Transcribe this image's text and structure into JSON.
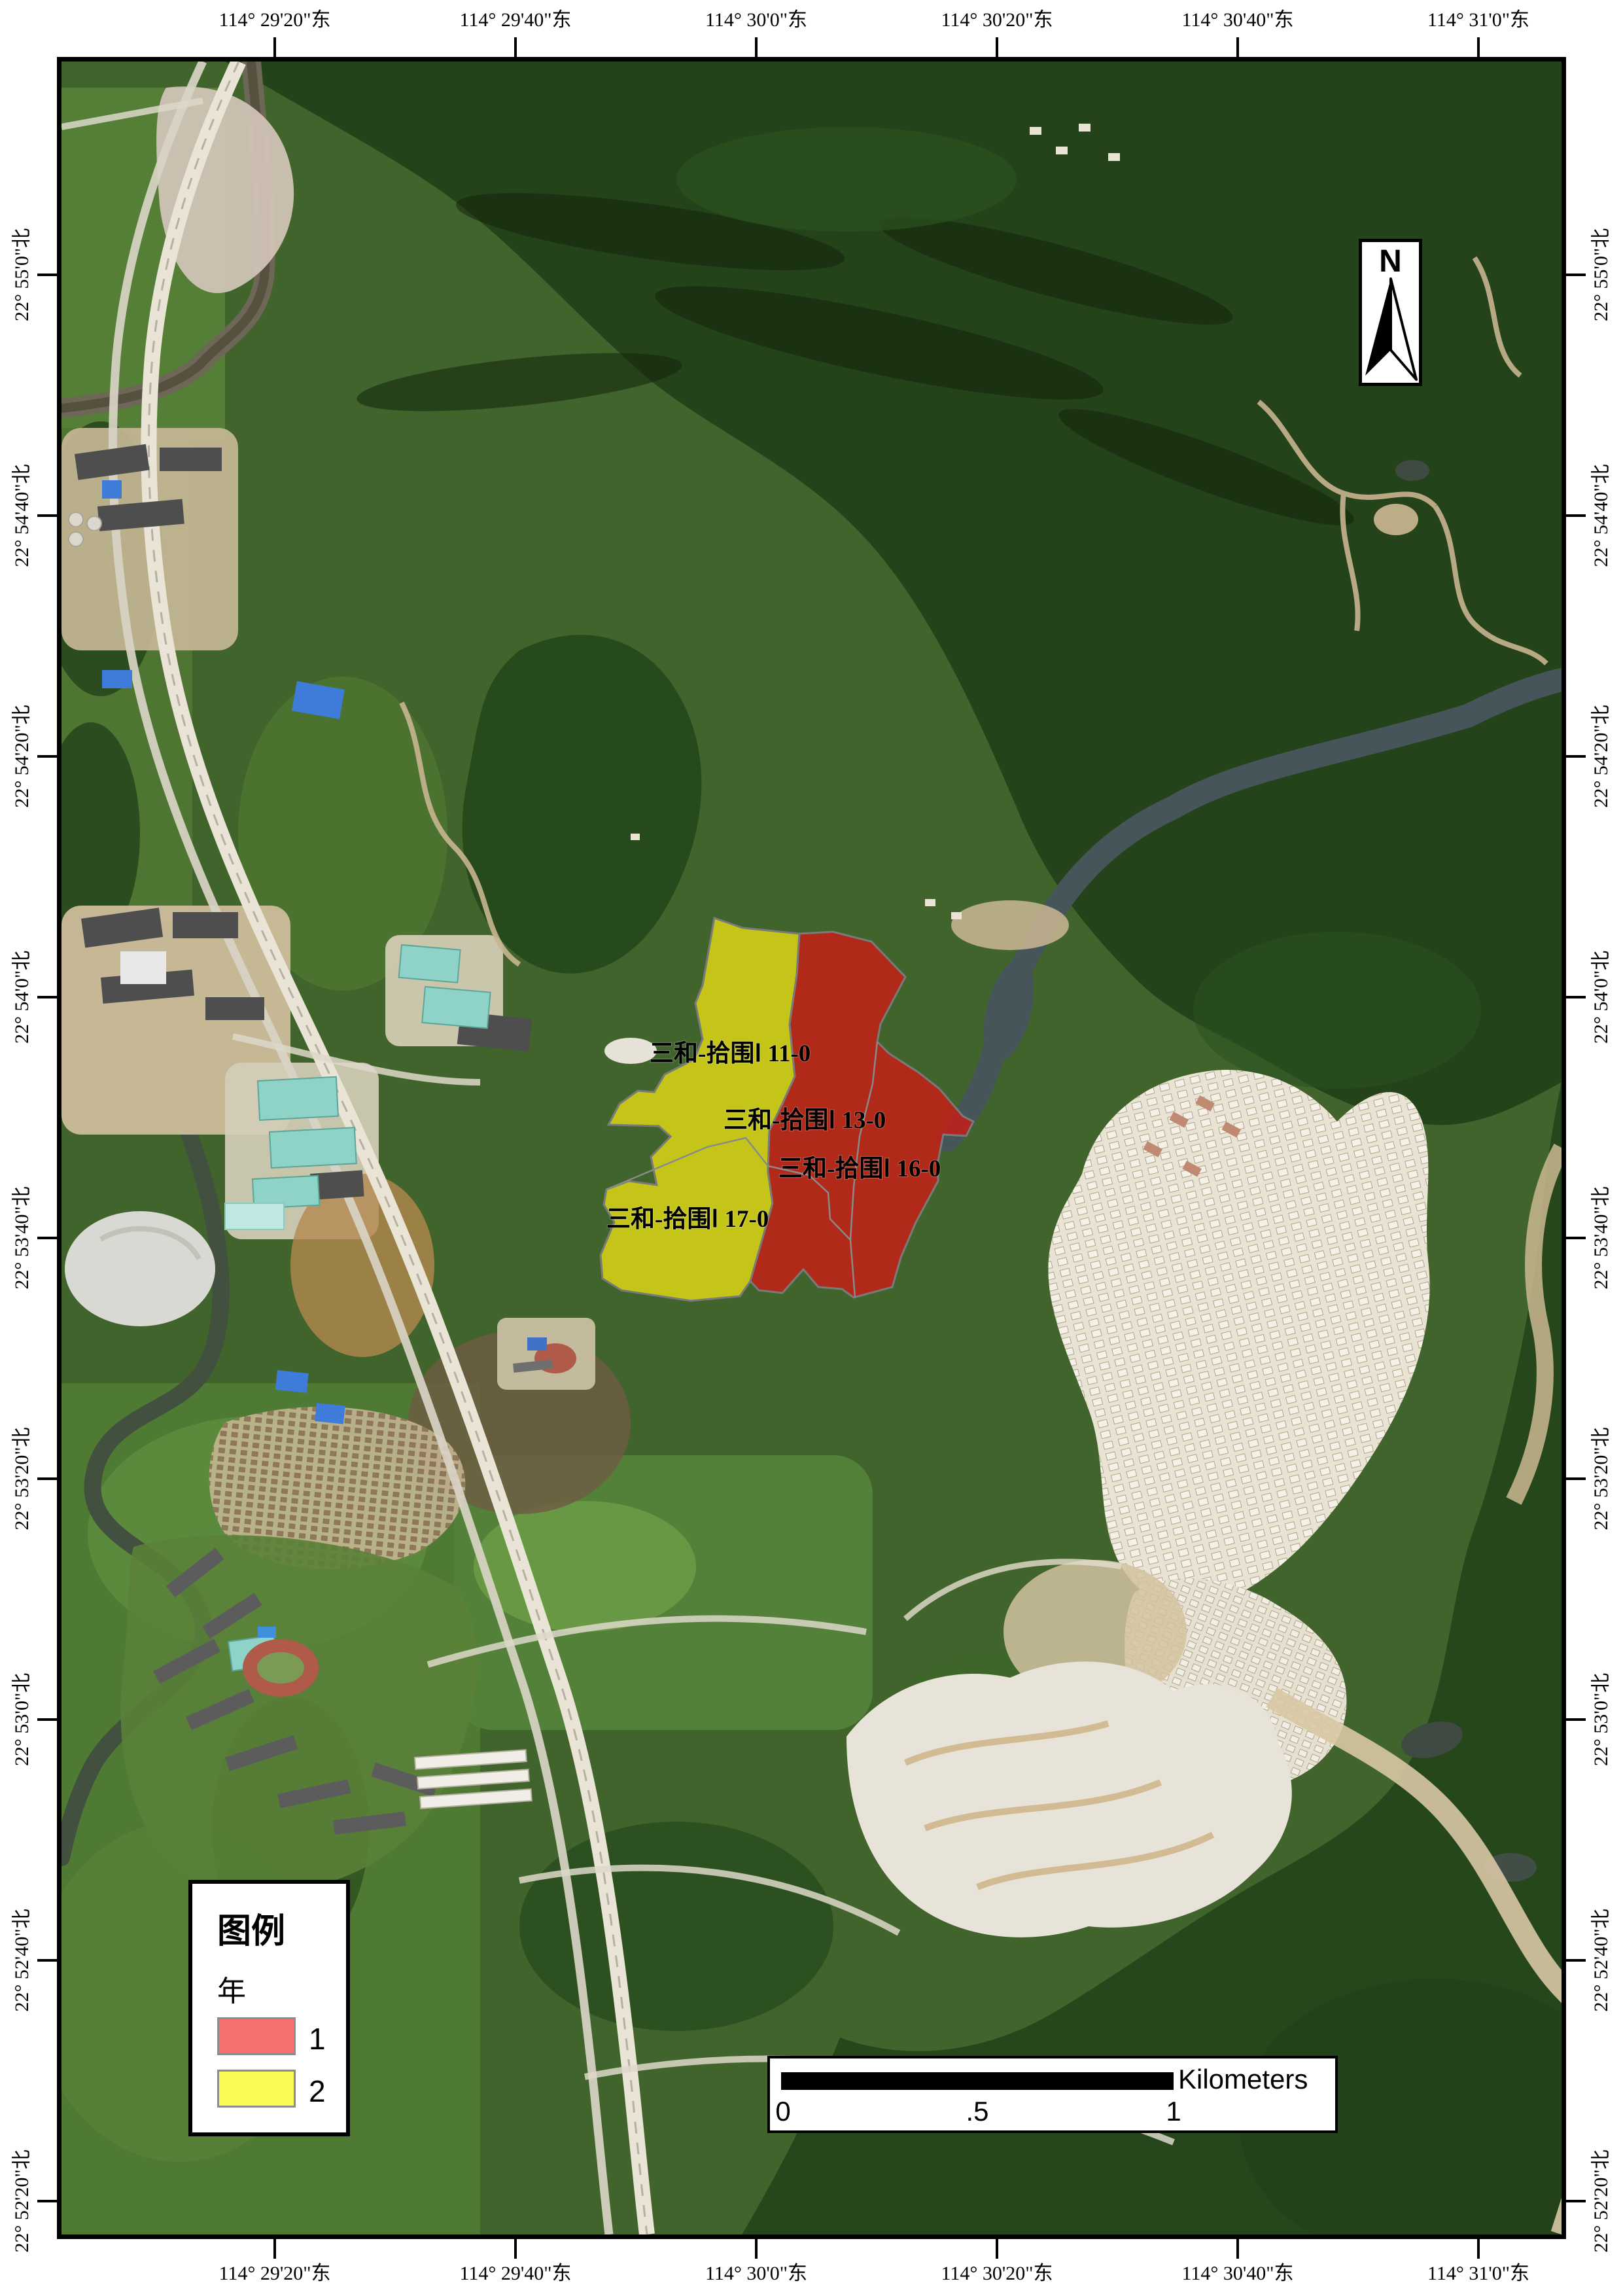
{
  "axes": {
    "top": [
      "114° 29'20\"东",
      "114° 29'40\"东",
      "114° 30'0\"东",
      "114° 30'20\"东",
      "114° 30'40\"东",
      "114° 31'0\"东"
    ],
    "bottom": [
      "114° 29'20\"东",
      "114° 29'40\"东",
      "114° 30'0\"东",
      "114° 30'20\"东",
      "114° 30'40\"东",
      "114° 31'0\"东"
    ],
    "left": [
      "22° 55'0\"北",
      "22° 54'40\"北",
      "22° 54'20\"北",
      "22° 54'0\"北",
      "22° 53'40\"北",
      "22° 53'20\"北",
      "22° 53'0\"北",
      "22° 52'40\"北",
      "22° 52'20\"北"
    ],
    "right": [
      "22° 55'0\"北",
      "22° 54'40\"北",
      "22° 54'20\"北",
      "22° 54'0\"北",
      "22° 53'40\"北",
      "22° 53'20\"北",
      "22° 53'0\"北",
      "22° 52'40\"北",
      "22° 52'20\"北"
    ]
  },
  "parcels": [
    {
      "id": "11-0",
      "label": "三和-拾围Ⅰ 11-0",
      "year": "2"
    },
    {
      "id": "13-0",
      "label": "三和-拾围Ⅰ 13-0",
      "year": "1"
    },
    {
      "id": "16-0",
      "label": "三和-拾围Ⅰ 16-0",
      "year": "1"
    },
    {
      "id": "17-0",
      "label": "三和-拾围Ⅰ 17-0",
      "year": "2"
    }
  ],
  "legend": {
    "title": "图例",
    "field": "年",
    "items": [
      {
        "value": "1",
        "swatch_color": "#f4716e"
      },
      {
        "value": "2",
        "swatch_color": "#fbfb55"
      }
    ]
  },
  "scale_bar": {
    "unit": "Kilometers",
    "ticks": [
      "0",
      ".5",
      "1"
    ]
  },
  "north_arrow": {
    "label": "N"
  },
  "map_colors": {
    "year_1_fill": "#c41f16",
    "year_2_fill": "#d6d316",
    "parcel_boundary": "#7a7a7a"
  }
}
